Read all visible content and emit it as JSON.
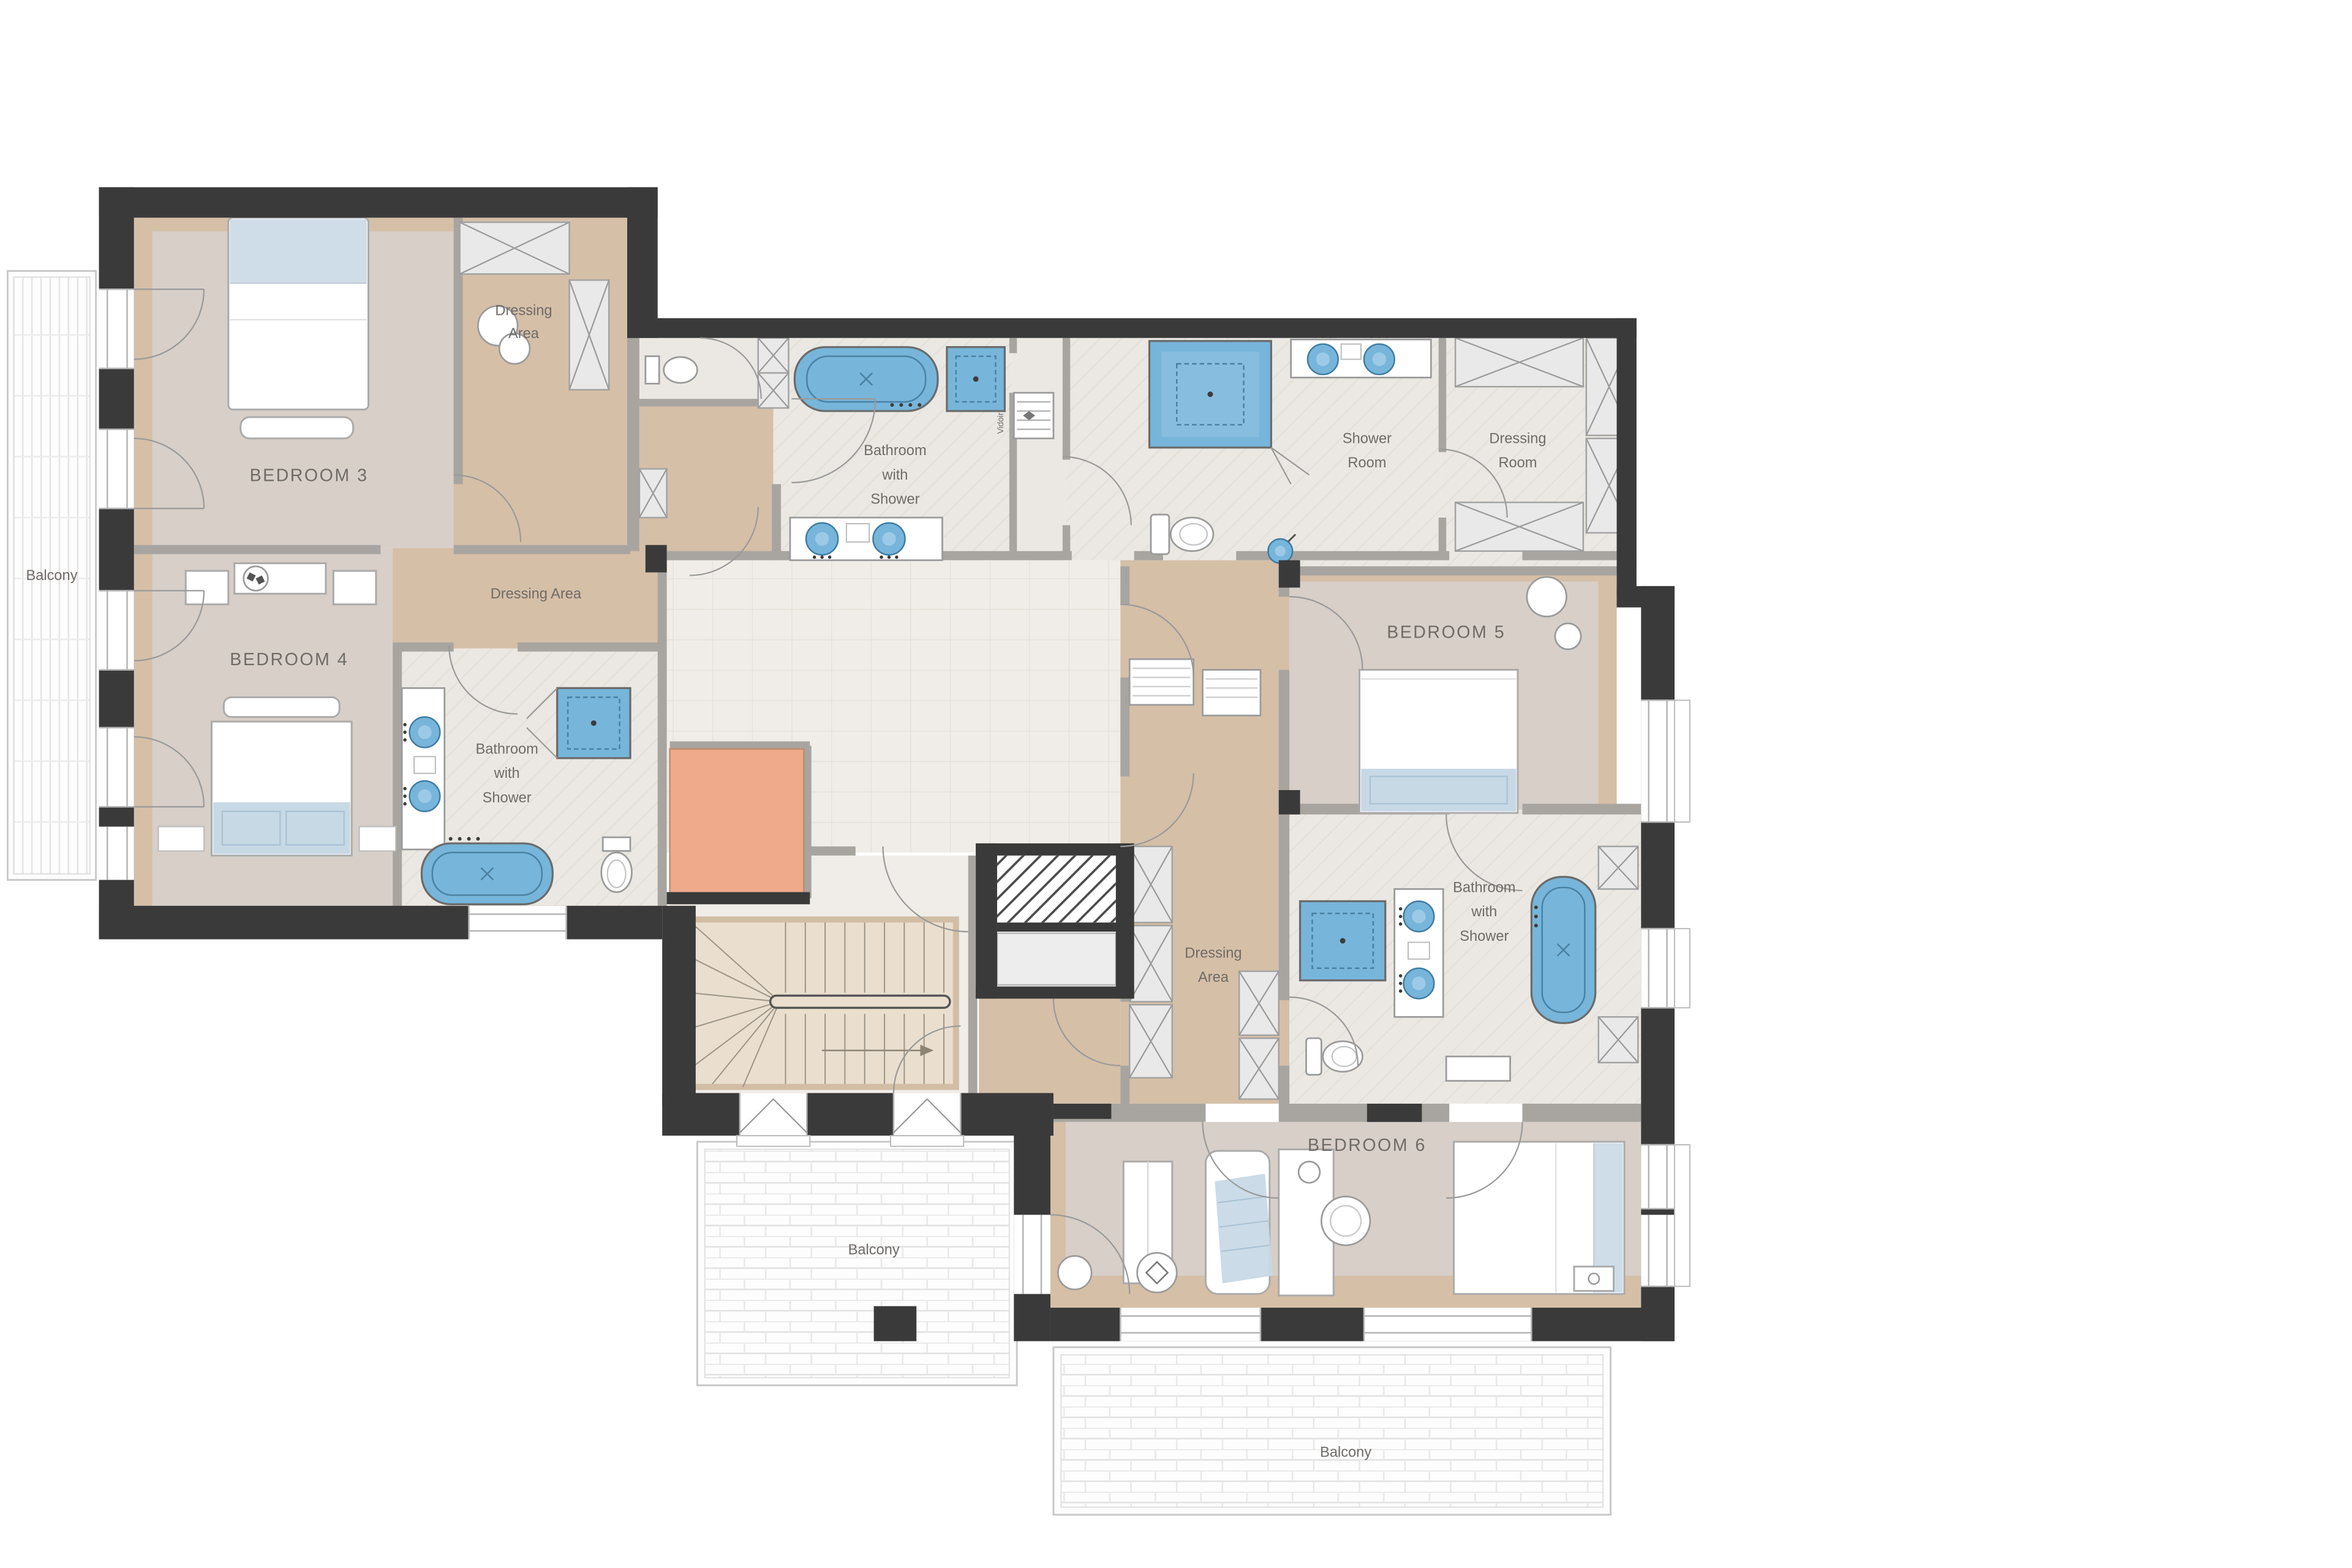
{
  "colors": {
    "wall": "#3a3a3a",
    "interior_wall": "#a8a5a1",
    "bedroom_floor": "#d7cfc8",
    "tan_floor": "#d5bfa7",
    "bath_floor": "#ebe8e3",
    "hall_floor": "#f0ede8",
    "fixture_blue": "#77b5da",
    "fixture_blue_light": "#9ccae6",
    "salmon": "#efaa8b",
    "stair_wood": "#eadfce",
    "closet_fill": "#e9e9e9",
    "bed_pillow": "#cfdde9",
    "bed_foot": "#c8d9e6",
    "balcony_line": "#c9c9c9",
    "label_text": "#6f6b66"
  },
  "labels": {
    "bedroom3": "BEDROOM 3",
    "bedroom4": "BEDROOM 4",
    "bedroom5": "BEDROOM 5",
    "bedroom6": "BEDROOM 6",
    "balcony_left": "Balcony",
    "balcony_bottom": "Balcony",
    "balcony_bottom_right": "Balcony",
    "dressing_area_top": [
      "Dressing",
      "Area"
    ],
    "dressing_area_mid": "Dressing Area",
    "dressing_area_b6": [
      "Dressing",
      "Area"
    ],
    "shower_room": [
      "Shower",
      "Room"
    ],
    "dressing_room": [
      "Dressing",
      "Room"
    ],
    "bathroom_top": [
      "Bathroom",
      "with",
      "Shower"
    ],
    "bathroom_left": [
      "Bathroom",
      "with",
      "Shower"
    ],
    "bathroom_right": [
      "Bathroom",
      "with",
      "Shower"
    ],
    "vidoir": "Vidoir"
  }
}
